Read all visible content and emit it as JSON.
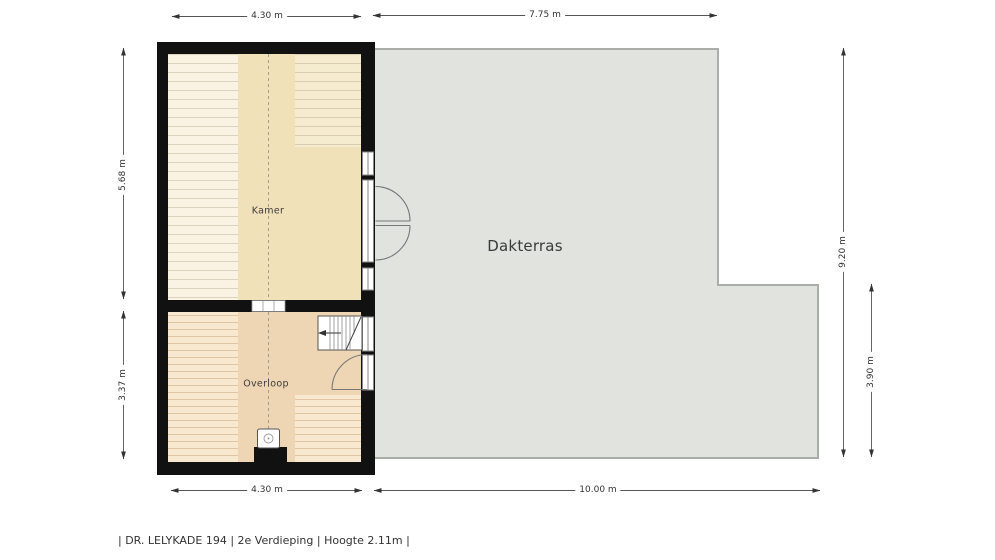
{
  "plan": {
    "type": "floorplan",
    "rooms": [
      {
        "name": "Kamer"
      },
      {
        "name": "Overloop"
      },
      {
        "name": "Dakterras"
      }
    ],
    "features": [
      "french-doors-to-terrace",
      "single-door-overloop",
      "staircase-down",
      "mechanical-vent-unit",
      "ridge-dashed-line"
    ]
  },
  "dimensions": {
    "top_kamer": "4.30 m",
    "top_dakterras": "7.75 m",
    "left_kamer": "5.68 m",
    "left_overloop": "3.37 m",
    "right_dakterras": "9.20 m",
    "right_dakterras_lower": "3.90 m",
    "bottom_kamer": "4.30 m",
    "bottom_dakterras": "10.00 m"
  },
  "footer": {
    "caption": "| DR. LELYKADE 194 | 2e Verdieping | Hoogte 2.11m |"
  },
  "colors": {
    "wall": "#111111",
    "kamer_floor_light": "#faf3e3",
    "kamer_floor_tan": "#f1e1b8",
    "overloop_floor_light": "#f8e8d0",
    "overloop_floor_tan": "#eed6b4",
    "terrace_fill": "#e1e3de",
    "terrace_border": "#abada8",
    "dimension_line": "#444444"
  }
}
